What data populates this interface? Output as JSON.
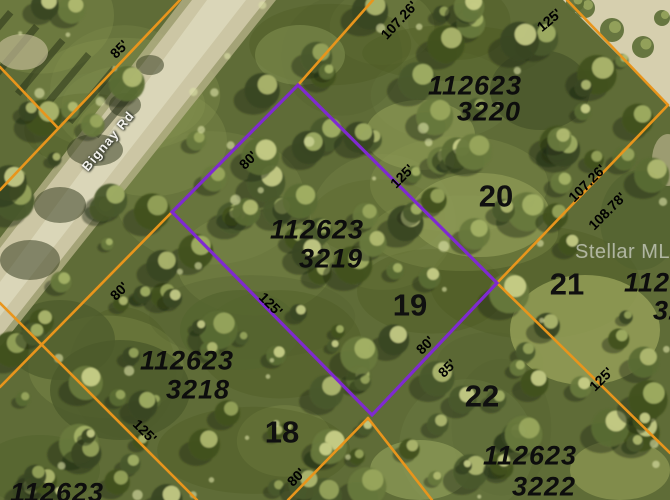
{
  "map": {
    "road": {
      "name": "Bignay Rd"
    },
    "watermark": {
      "text": "Stellar MLS"
    },
    "colors": {
      "boundary_line": "#e8951c",
      "highlight_outline": "#7f2ad0",
      "label_text": "#0d0d0d",
      "road_surface": "#ccc6a4",
      "sand_corner": "#d6cfae"
    },
    "highlighted_parcel": {
      "id": "112623 3219",
      "lot": "19"
    },
    "lots_visible": [
      "18",
      "19",
      "20",
      "21",
      "22"
    ],
    "parcel_ids_visible": [
      "112623 3220",
      "112623 3219",
      "112623 3218",
      "112623 3222",
      "112623"
    ],
    "highlight_polygon": [
      [
        298,
        85
      ],
      [
        497,
        283
      ],
      [
        372,
        415
      ],
      [
        172,
        212
      ]
    ],
    "boundary_segments": [
      [
        180,
        0,
        0,
        190
      ],
      [
        0,
        67,
        58,
        128
      ],
      [
        172,
        212,
        0,
        387
      ],
      [
        0,
        303,
        197,
        500
      ],
      [
        298,
        85,
        373,
        0
      ],
      [
        567,
        0,
        668,
        105
      ],
      [
        668,
        105,
        497,
        283
      ],
      [
        497,
        283,
        670,
        453
      ],
      [
        368,
        418,
        288,
        500
      ],
      [
        368,
        418,
        432,
        500
      ]
    ],
    "labels": {
      "parcel_id_labels": [
        {
          "text": "112623",
          "x": 475,
          "y": 86
        },
        {
          "text": "3220",
          "x": 489,
          "y": 112
        },
        {
          "text": "112623",
          "x": 317,
          "y": 230
        },
        {
          "text": "3219",
          "x": 331,
          "y": 259
        },
        {
          "text": "112623",
          "x": 187,
          "y": 361
        },
        {
          "text": "3218",
          "x": 198,
          "y": 390
        },
        {
          "text": "112623",
          "x": 530,
          "y": 456
        },
        {
          "text": "3222",
          "x": 544,
          "y": 487
        },
        {
          "text": "112623",
          "x": 57,
          "y": 493
        },
        {
          "text": "1126",
          "x": 655,
          "y": 283
        },
        {
          "text": "32",
          "x": 669,
          "y": 311
        }
      ],
      "lot_number_labels": [
        {
          "text": "20",
          "x": 496,
          "y": 196
        },
        {
          "text": "19",
          "x": 410,
          "y": 305
        },
        {
          "text": "21",
          "x": 567,
          "y": 284
        },
        {
          "text": "18",
          "x": 282,
          "y": 432
        },
        {
          "text": "22",
          "x": 482,
          "y": 396
        }
      ],
      "dimension_labels": [
        {
          "text": "85'",
          "x": 119,
          "y": 49,
          "rot": -45
        },
        {
          "text": "80'",
          "x": 248,
          "y": 160,
          "rot": -45
        },
        {
          "text": "125'",
          "x": 402,
          "y": 176,
          "rot": -45
        },
        {
          "text": "107.26'",
          "x": 399,
          "y": 20,
          "rot": -47
        },
        {
          "text": "125'",
          "x": 549,
          "y": 20,
          "rot": -40
        },
        {
          "text": "107.26'",
          "x": 587,
          "y": 183,
          "rot": -45
        },
        {
          "text": "108.78'",
          "x": 607,
          "y": 211,
          "rot": -45
        },
        {
          "text": "125'",
          "x": 271,
          "y": 304,
          "rot": 45
        },
        {
          "text": "80'",
          "x": 119,
          "y": 291,
          "rot": -45
        },
        {
          "text": "125'",
          "x": 145,
          "y": 431,
          "rot": 45
        },
        {
          "text": "80'",
          "x": 296,
          "y": 477,
          "rot": -45
        },
        {
          "text": "80'",
          "x": 425,
          "y": 345,
          "rot": -45
        },
        {
          "text": "85'",
          "x": 447,
          "y": 368,
          "rot": -45
        },
        {
          "text": "125'",
          "x": 601,
          "y": 379,
          "rot": -45
        }
      ]
    }
  }
}
